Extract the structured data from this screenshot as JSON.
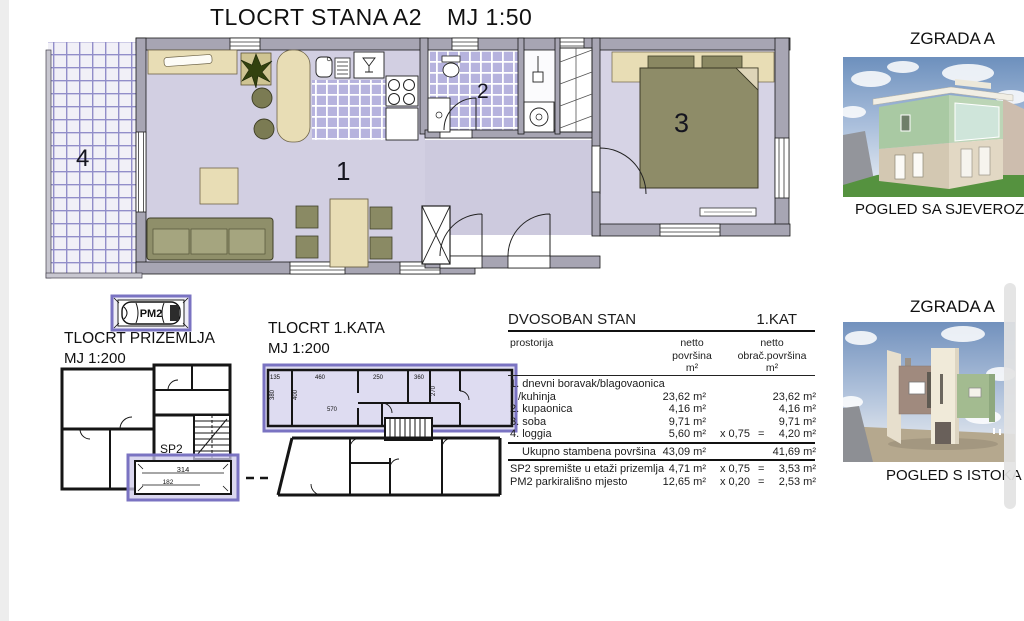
{
  "page": {
    "title": "TLOCRT STANA A2",
    "title_scale": "MJ 1:50"
  },
  "main_plan": {
    "rooms": {
      "living": "1",
      "bath": "2",
      "bedroom": "3",
      "loggia": "4"
    }
  },
  "ground_plan": {
    "label_line1": "TLOCRT PRIZEMLJA",
    "label_line2": "MJ 1:200",
    "parking_label": "PM2",
    "storage_label": "SP2",
    "storage_dims": {
      "width": "314",
      "depth": "182"
    }
  },
  "first_floor_plan": {
    "label_line1": "TLOCRT 1.KATA",
    "label_line2": "MJ 1:200",
    "dims": {
      "d135": "135",
      "d460": "460",
      "d250": "250",
      "d360": "360",
      "d380": "380",
      "d400": "400",
      "d570": "570",
      "d270": "270"
    }
  },
  "area_table": {
    "title": "DVOSOBAN STAN",
    "floor": "1.KAT",
    "columns": {
      "room": "prostorija",
      "netto1": "netto",
      "netto2": "površina",
      "netto3": "m²",
      "obr1": "netto",
      "obr2": "obrač.površina",
      "obr3": "m²"
    },
    "rows": [
      {
        "name": "1. dnevni boravak/blagovaonica",
        "name2": "/kuhinja",
        "netto": "23,62 m²",
        "factor": "",
        "eq": "",
        "obracun": "23,62 m²"
      },
      {
        "name": "2. kupaonica",
        "netto": "4,16 m²",
        "factor": "",
        "eq": "",
        "obracun": "4,16 m²"
      },
      {
        "name": "3. soba",
        "netto": "9,71 m²",
        "factor": "",
        "eq": "",
        "obracun": "9,71 m²"
      },
      {
        "name": "4. loggia",
        "netto": "5,60 m²",
        "factor": "x 0,75",
        "eq": "=",
        "obracun": "4,20 m²"
      }
    ],
    "total": {
      "name": "Ukupno stambena površina",
      "netto": "43,09 m²",
      "obracun": "41,69 m²"
    },
    "extras": [
      {
        "name": "SP2 spremište u etaži prizemlja",
        "netto": "4,71 m²",
        "factor": "x 0,75",
        "eq": "=",
        "obracun": "3,53 m²"
      },
      {
        "name": "PM2 parkirališno mjesto",
        "netto": "12,65 m²",
        "factor": "x 0,20",
        "eq": "=",
        "obracun": "2,53 m²"
      }
    ]
  },
  "renders": {
    "north": {
      "title": "ZGRADA A",
      "caption": "POGLED SA SJEVEROZAPADA"
    },
    "east": {
      "title": "ZGRADA A",
      "caption": "POGLED S ISTOKA"
    }
  }
}
